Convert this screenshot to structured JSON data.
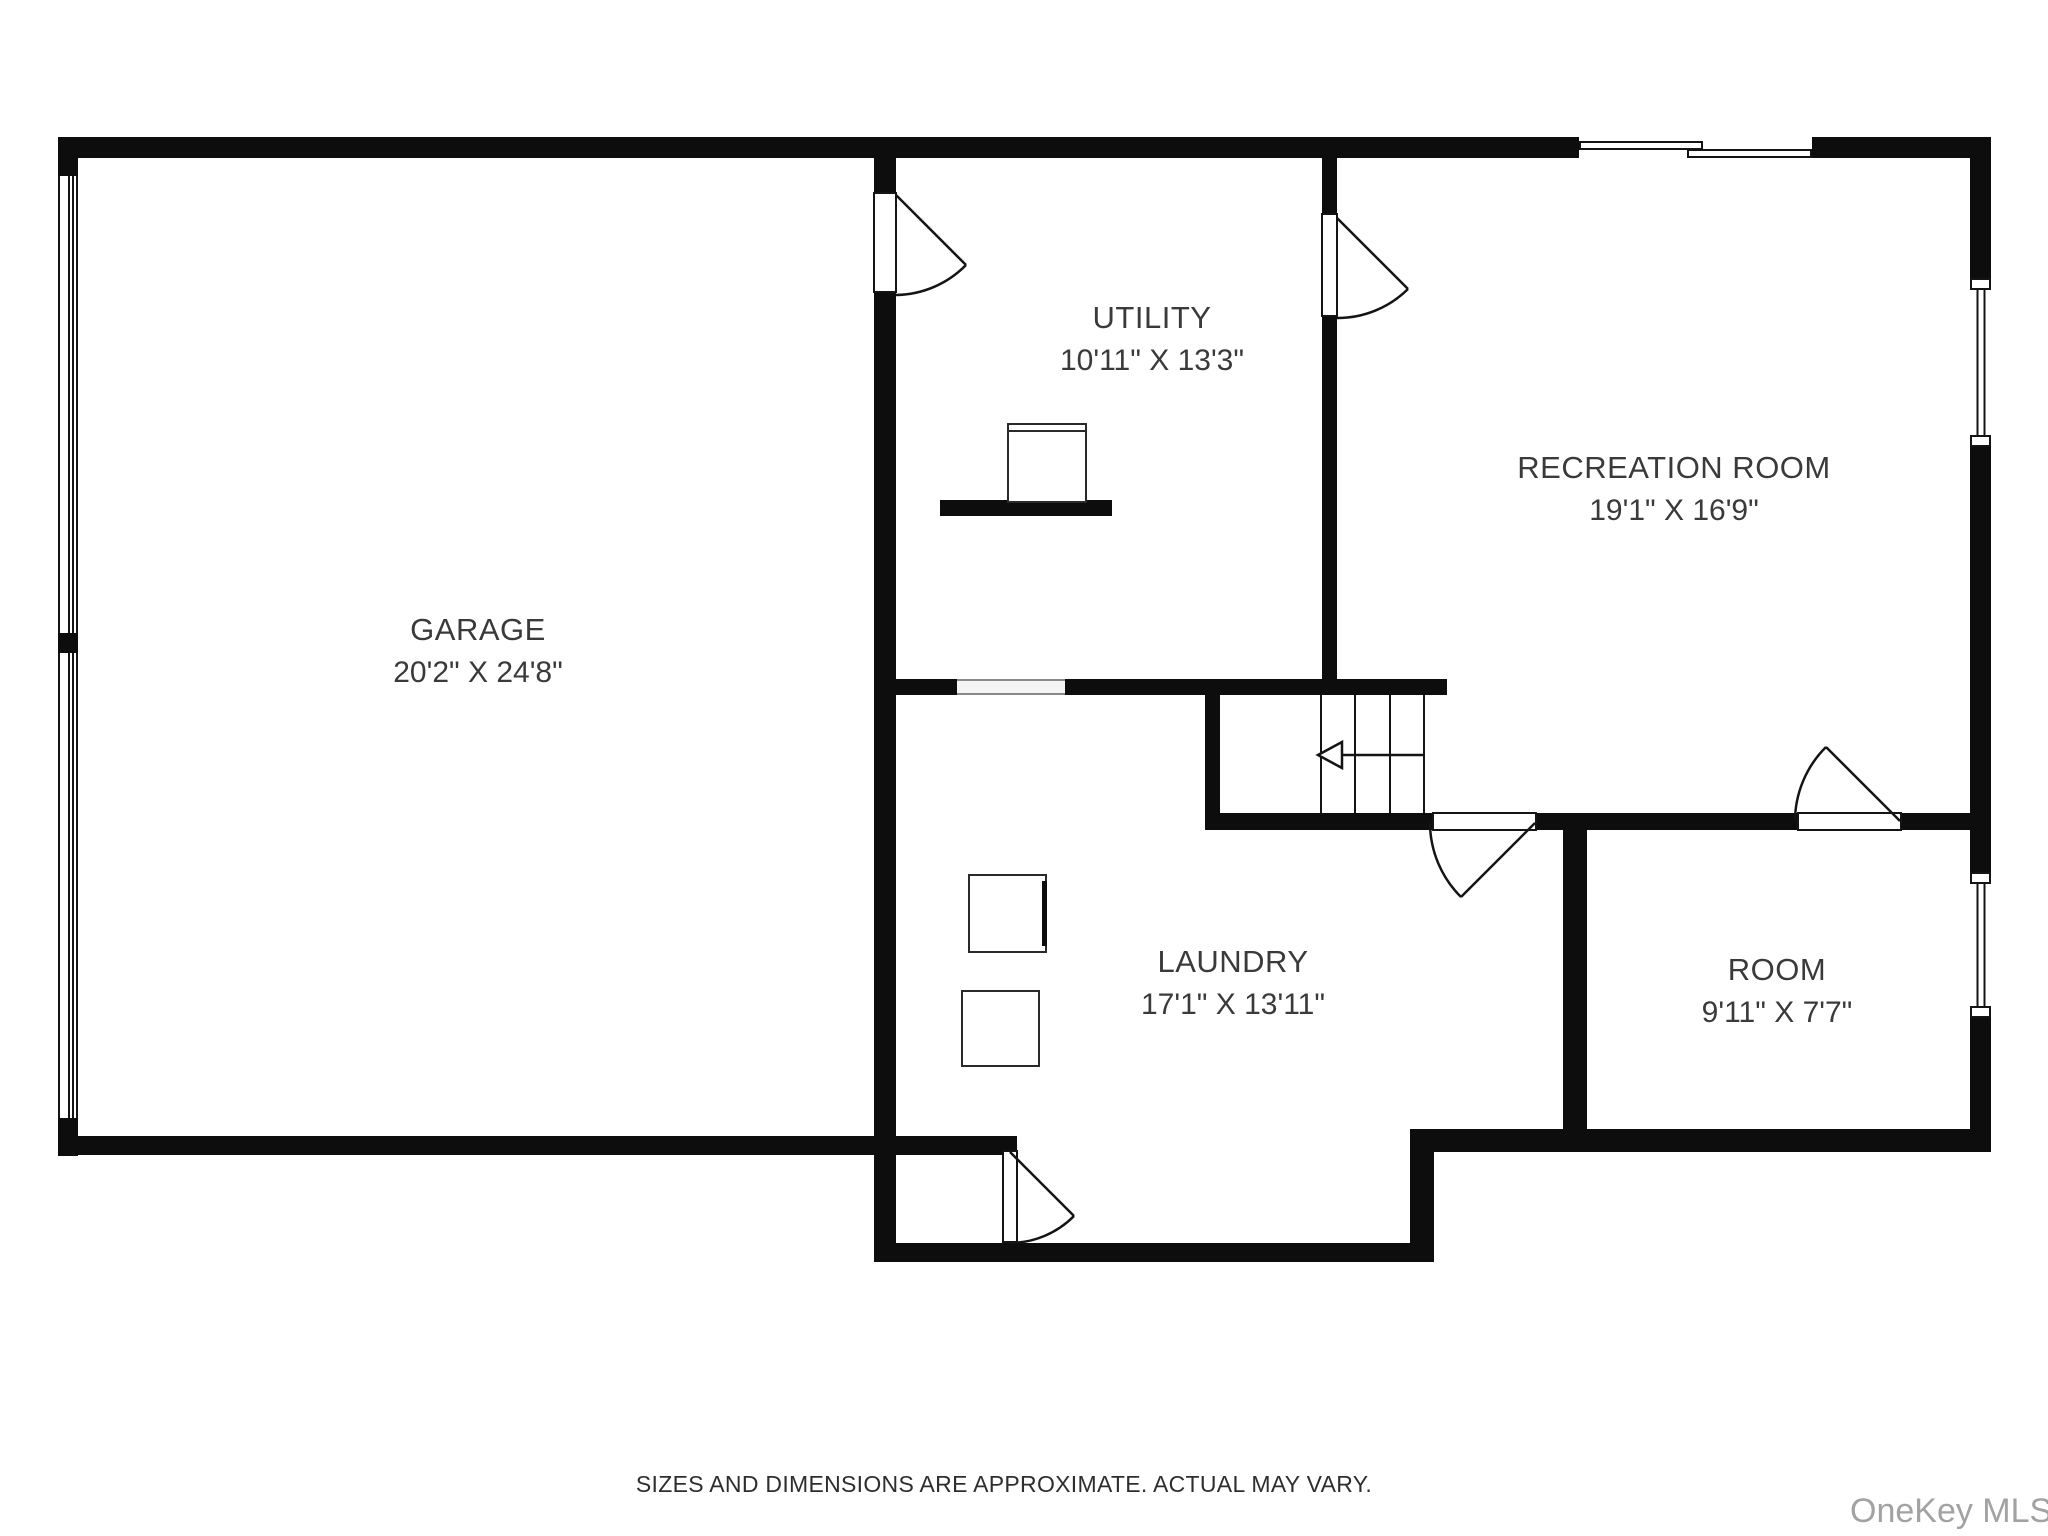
{
  "plan": {
    "type": "basement floor plan",
    "background": "#ffffff",
    "wall_color": "#0d0d0d",
    "text_color": "#3a3a3a"
  },
  "rooms": [
    {
      "id": "garage",
      "name": "GARAGE",
      "dimensions": "20'2\" X 24'8\""
    },
    {
      "id": "utility",
      "name": "UTILITY",
      "dimensions": "10'11\" X 13'3\""
    },
    {
      "id": "recreation",
      "name": "RECREATION ROOM",
      "dimensions": "19'1\" X 16'9\""
    },
    {
      "id": "laundry",
      "name": "LAUNDRY",
      "dimensions": "17'1\" X 13'11\""
    },
    {
      "id": "room",
      "name": "ROOM",
      "dimensions": "9'11\" X 7'7\""
    }
  ],
  "footer": {
    "disclaimer": "SIZES AND DIMENSIONS ARE APPROXIMATE. ACTUAL MAY VARY."
  },
  "watermark": {
    "text": "OneKey MLS",
    "color": "#a2a2a2"
  }
}
